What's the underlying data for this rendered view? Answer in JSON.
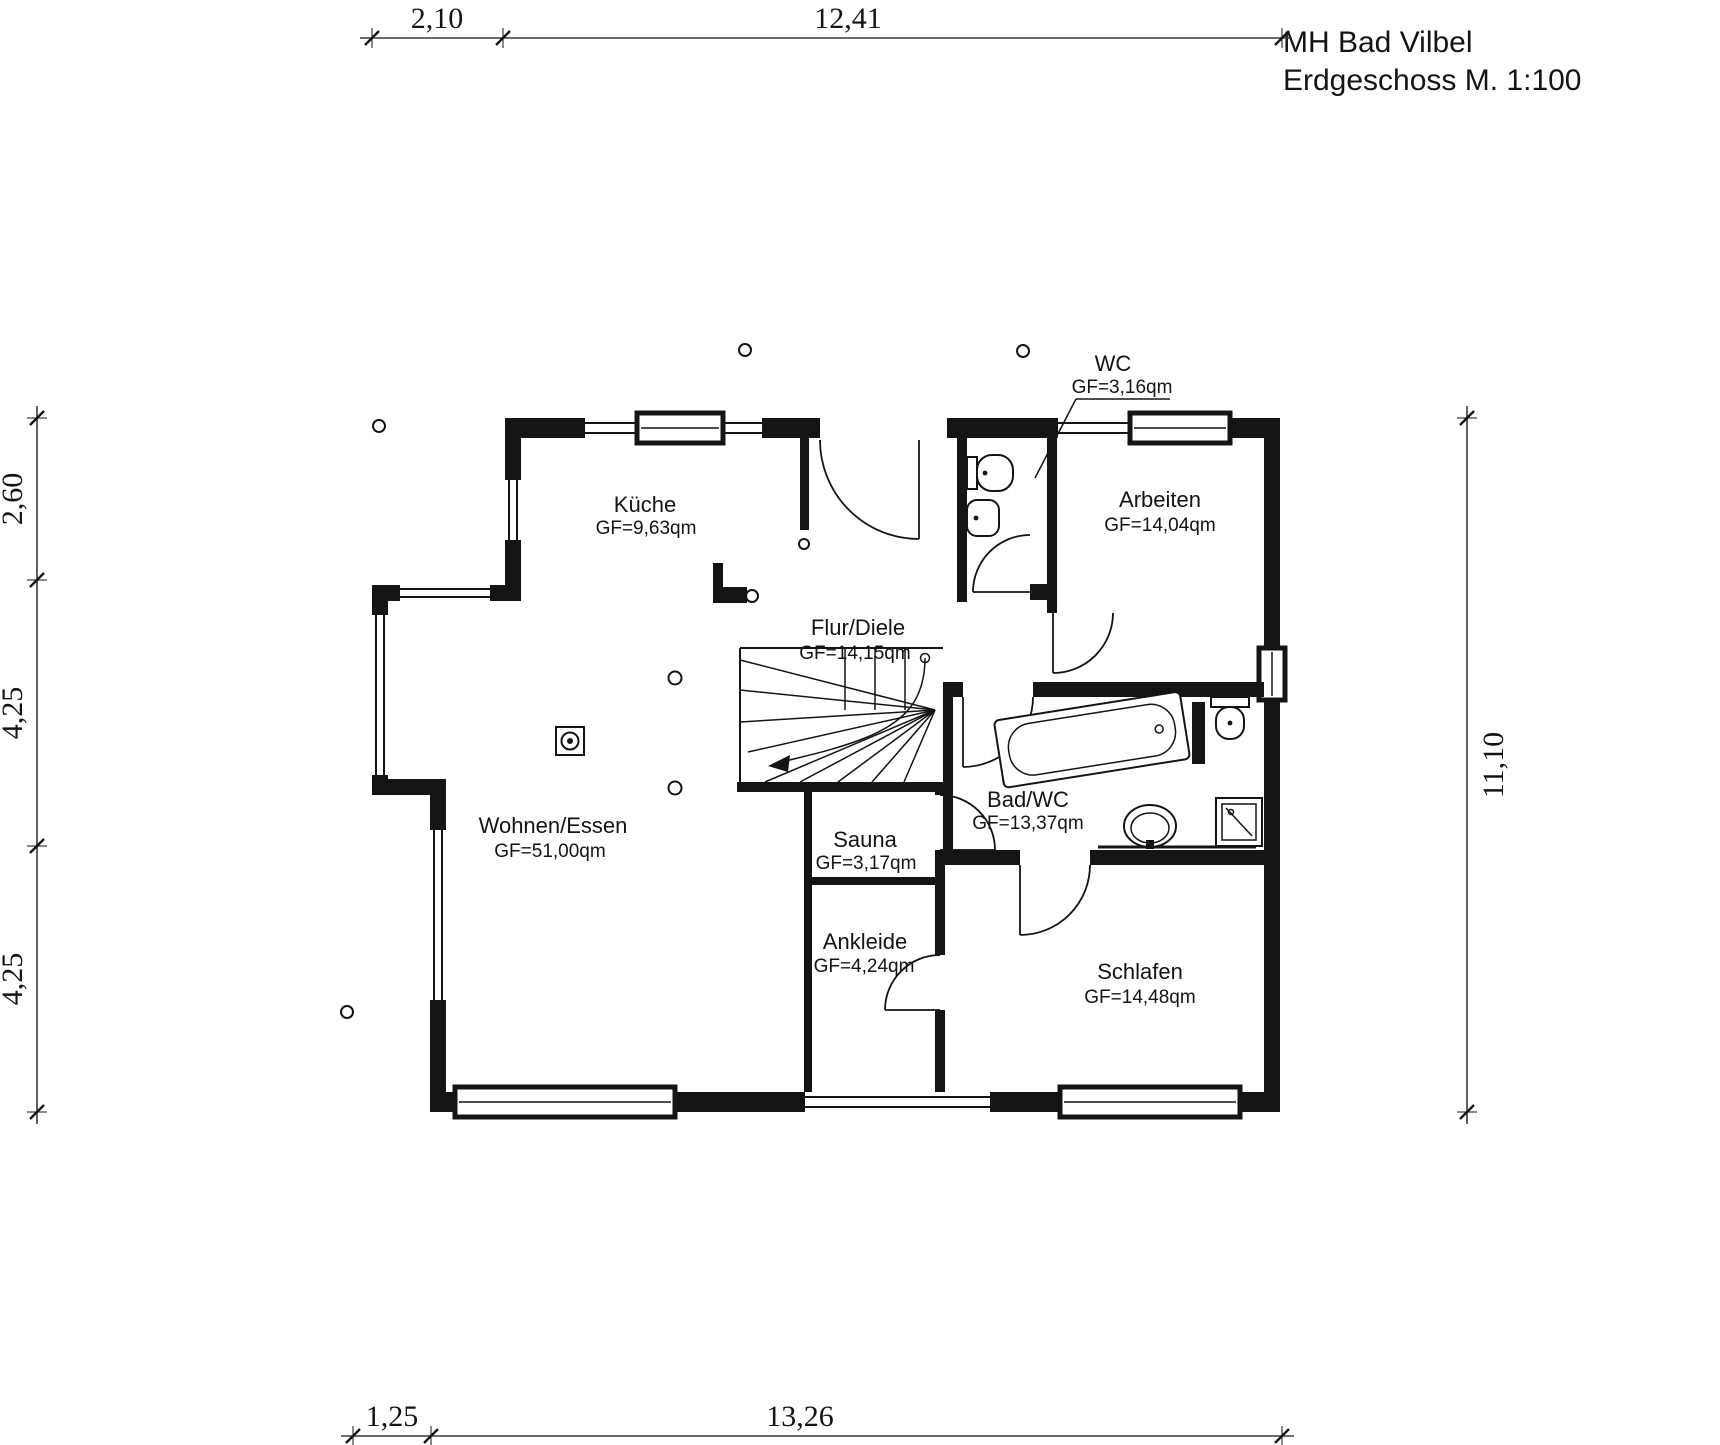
{
  "page": {
    "background": "#ffffff",
    "ink": "#141414"
  },
  "title": {
    "line1": "MH Bad Vilbel",
    "line2": "Erdgeschoss M. 1:100"
  },
  "dimensions": {
    "top": [
      "2,10",
      "12,41"
    ],
    "bottom": [
      "1,25",
      "13,26"
    ],
    "left": [
      "2,60",
      "4,25",
      "4,25"
    ],
    "right": [
      "11,10"
    ]
  },
  "rooms": [
    {
      "name": "Küche",
      "area": "GF=9,63qm"
    },
    {
      "name": "Flur/Diele",
      "area": "GF=14,15qm"
    },
    {
      "name": "WC",
      "area": "GF=3,16qm"
    },
    {
      "name": "Arbeiten",
      "area": "GF=14,04qm"
    },
    {
      "name": "Bad/WC",
      "area": "GF=13,37qm"
    },
    {
      "name": "Wohnen/Essen",
      "area": "GF=51,00qm"
    },
    {
      "name": "Sauna",
      "area": "GF=3,17qm"
    },
    {
      "name": "Ankleide",
      "area": "GF=4,24qm"
    },
    {
      "name": "Schlafen",
      "area": "GF=14,48qm"
    }
  ],
  "fixtures": [
    "toilet-icon",
    "washbasin-icon",
    "bathtub-icon",
    "shower-icon",
    "staircase-icon",
    "chimney-icon",
    "door-swing-icon",
    "window-icon"
  ]
}
